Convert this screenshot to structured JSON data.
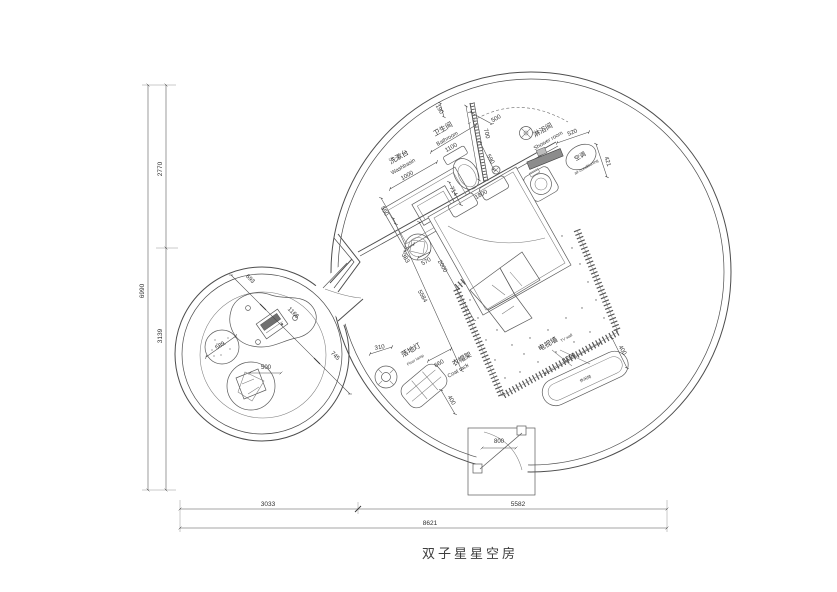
{
  "title": "双子星星空房",
  "outer_dims": {
    "v_total": "6990",
    "v_top": "2770",
    "v_bottom": "3139",
    "h_left": "3033",
    "h_right": "5582",
    "h_total": "8621"
  },
  "lounge_room": {
    "seg1": "693",
    "seg2": "1166",
    "seg3": "745",
    "pouf_dia": "589",
    "beanbag_dia": "500"
  },
  "washbasin": {
    "zh": "洗漱台",
    "en": "Washbasin",
    "width": "1000",
    "depth": "550"
  },
  "bathroom": {
    "zh": "卫生间",
    "en": "Bathroom",
    "width": "1100",
    "top_gap": "190",
    "wall": "700",
    "toilet": "714",
    "drain": "590"
  },
  "shower": {
    "zh": "淋浴间",
    "en": "Shower room",
    "width": "500",
    "bench": "520",
    "side": "421"
  },
  "ac": {
    "zh": "空调",
    "en": "air-conditioning"
  },
  "bed": {
    "headboard": "1800",
    "length": "2000",
    "diagonal": "5584",
    "stool_w": "383",
    "stool_h": "570"
  },
  "floor_lamp": {
    "zh": "落地灯",
    "en": "Floor lamp",
    "dia": "310"
  },
  "coat_rack": {
    "zh": "衣帽架",
    "en": "Coat rack",
    "width": "660",
    "depth": "400"
  },
  "tv_wall": {
    "zh": "电视墙",
    "en": "TV wall",
    "width": "1200",
    "depth": "400",
    "chair": "休闲椅"
  },
  "entrance": {
    "door_width": "800"
  },
  "colors": {
    "line": "#4d4d4d",
    "paper": "#ffffff",
    "hatch": "#555555"
  }
}
